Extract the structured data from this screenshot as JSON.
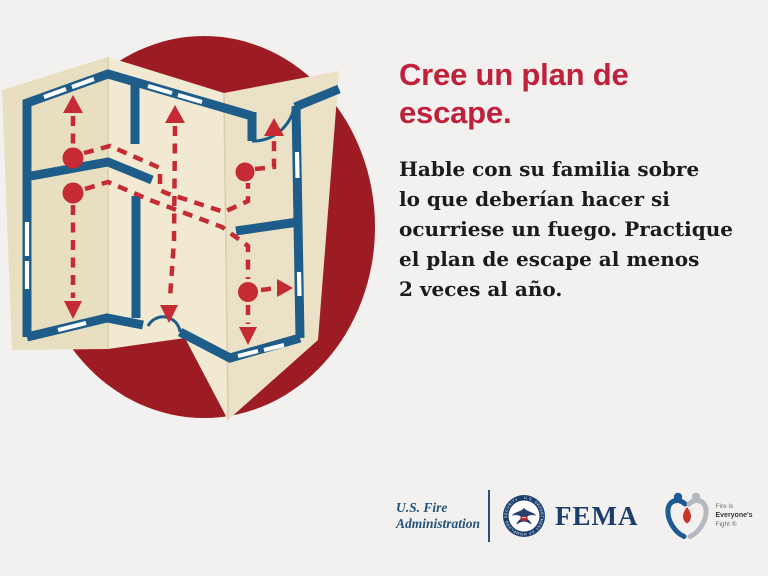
{
  "hero": {
    "title_lines": [
      "Cree un plan de",
      "escape."
    ],
    "body_lines": [
      "Hable con su familia sobre",
      "lo que deberían hacer si",
      "ocurriese un fuego. Practique",
      "el plan de escape al menos",
      "2 veces al año."
    ]
  },
  "illustration": {
    "name": "escape-plan-floor-map-in-red-circle"
  },
  "footer": {
    "usfa_lines": [
      "U.S. Fire",
      "Administration"
    ],
    "seal_ring_text": "U.S. DEPARTMENT OF HOMELAND SECURITY",
    "fema_label": "FEMA",
    "fief_lines": [
      "Fire is",
      "Everyone's",
      "Fight ®"
    ]
  },
  "palette": {
    "background": "#f2f1ef",
    "circle_red": "#9d1c24",
    "paper_cream": "#ece3c8",
    "wall_blue": "#1e5c8a",
    "route_red": "#c62a33",
    "title_red": "#c0213a",
    "fema_navy": "#1c3e6e",
    "usfa_blue": "#23527c"
  }
}
